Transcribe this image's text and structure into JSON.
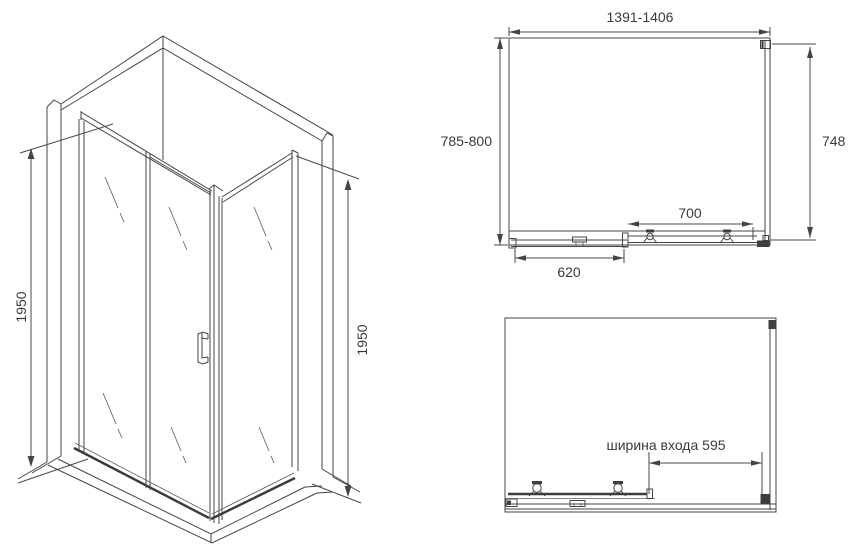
{
  "iso": {
    "height_left": "1950",
    "height_right": "1950"
  },
  "plan": {
    "width": "1391-1406",
    "depth": "785-800",
    "side": "748",
    "panel_width": "700",
    "door_width": "620"
  },
  "front": {
    "entry_width": "ширина входа 595"
  },
  "colors": {
    "ink": "#444444",
    "bg": "#ffffff"
  }
}
